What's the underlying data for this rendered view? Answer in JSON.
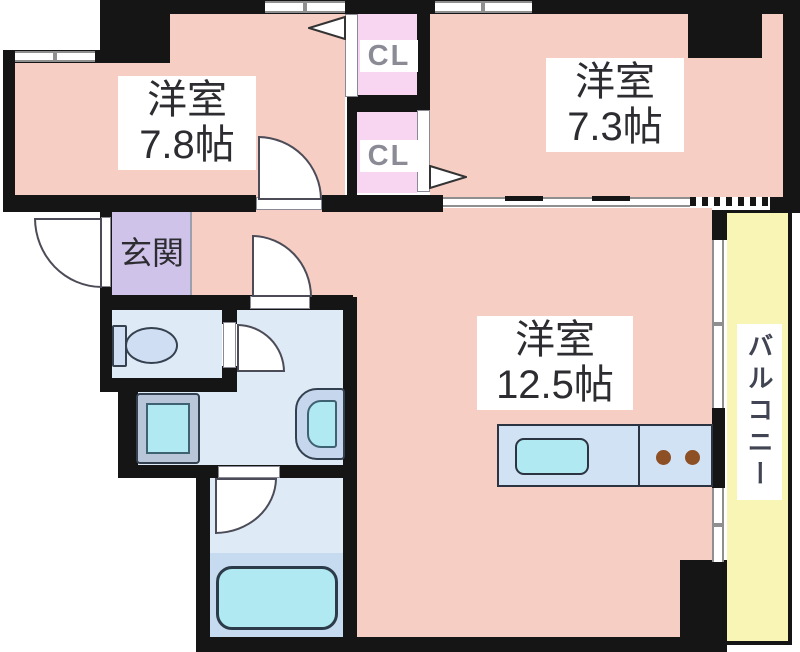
{
  "plan": {
    "title": "apartment-floor-plan",
    "rooms": {
      "western_78": {
        "name": "洋室",
        "size": "7.8帖"
      },
      "western_73": {
        "name": "洋室",
        "size": "7.3帖"
      },
      "western_125": {
        "name": "洋室",
        "size": "12.5帖"
      },
      "entrance": {
        "name": "玄関"
      }
    },
    "closets": [
      {
        "label": "CL"
      },
      {
        "label": "CL"
      }
    ],
    "balcony": {
      "label": "バルコニー"
    },
    "palette": {
      "room_pink": "#f7cec3",
      "closet_pink": "#f8d6f2",
      "entrance_purple": "#cfc3e9",
      "wet_blue": "#dfeaf7",
      "bath_blue": "#c6daf0",
      "fixture_cyan": "#b0e9f2",
      "counter_blue": "#d2e2f5",
      "balcony_yellow": "#f8f5b5",
      "burner_brown": "#8d4f24",
      "wall_black": "#151515"
    }
  }
}
